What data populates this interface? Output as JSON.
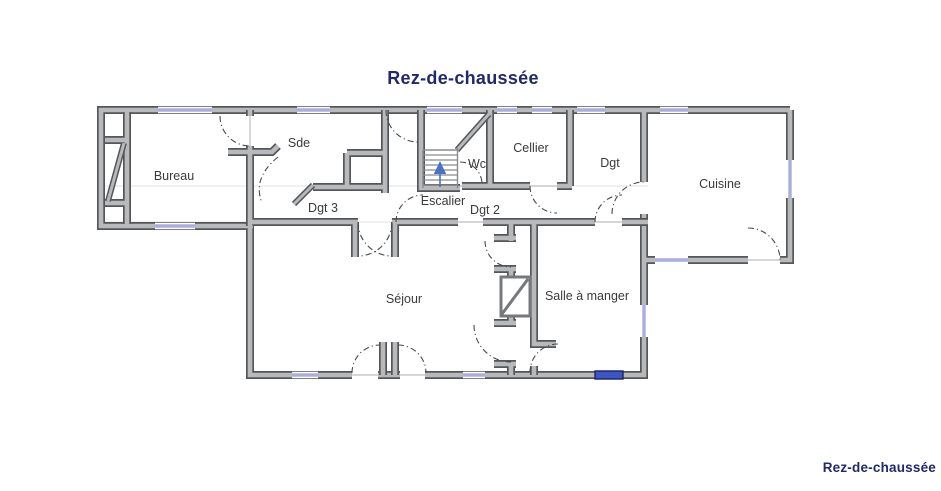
{
  "document": {
    "title_top": "Rez-de-chaussée",
    "title_bottom_right": "Rez-de-chaussée"
  },
  "floor_plan": {
    "rooms": {
      "bureau": "Bureau",
      "sde": "Sde",
      "dgt3": "Dgt 3",
      "escalier": "Escalier",
      "wc": "Wc",
      "dgt2": "Dgt 2",
      "cellier": "Cellier",
      "dgt": "Dgt",
      "cuisine": "Cuisine",
      "sejour": "Séjour",
      "salle_a_manger": "Salle à manger"
    },
    "symbols": {
      "stair_direction": "up"
    }
  },
  "colors": {
    "title_navy": "#20296b",
    "wall_fill": "#b7b9bb",
    "wall_edge": "#55565a",
    "window_glass": "#a9aede",
    "window_highlight": "#3d55c5",
    "door_arc": "#4a4a4a",
    "stair_arrow": "#4a72c4",
    "room_label_text": "#3a3a3a",
    "background": "#ffffff"
  }
}
